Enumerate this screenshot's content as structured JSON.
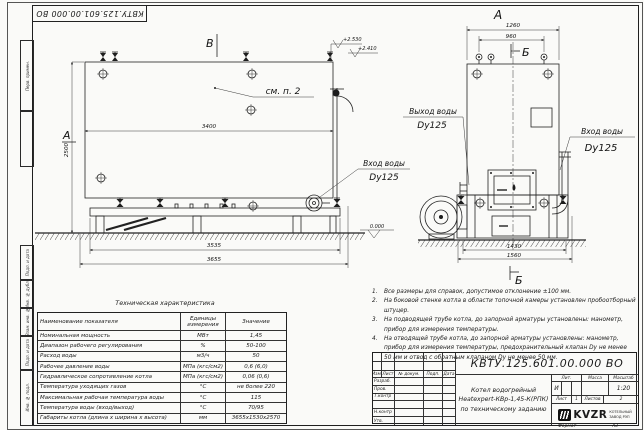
{
  "stamp": {
    "doc_number": "КВТУ.125.601.00.000  ВО"
  },
  "margin": {
    "labels": [
      "Перв. примен.",
      "Подп. и дата",
      "Инв. № дубл.",
      "Взам. инв. №",
      "Подп. и дата",
      "Инв. № подл."
    ]
  },
  "drawing": {
    "views": {
      "front_arrow": "В",
      "front_section": "А",
      "side_title": "А",
      "section_top": "Б",
      "section_bottom": "Б"
    },
    "dims": {
      "front_width": "3400",
      "front_height": "2500",
      "front_base": "3535",
      "front_overall": "3655",
      "side_top_outer": "1260",
      "side_top_inner": "960",
      "side_bottom_inner": "1430",
      "side_bottom_outer": "1560"
    },
    "elevations": {
      "e1": "+2.530",
      "e2": "+2.410",
      "ground": "0.000"
    },
    "callouts": {
      "see_note": "см. п. 2",
      "front_inlet": "Вход воды",
      "front_inlet_dn": "Dy125",
      "outlet": "Выход воды",
      "outlet_dn": "Dy125",
      "side_inlet": "Вход воды",
      "side_inlet_dn": "Dy125"
    }
  },
  "notes": {
    "items": [
      {
        "num": "1.",
        "text": "Все размеры для справок, допустимое отклонение ±100 мм."
      },
      {
        "num": "2.",
        "text": "На боковой стенке котла в области топочной камеры установлен пробоотборный штуцер."
      },
      {
        "num": "3.",
        "text": "На подводящей трубе котла, до запорной арматуры установлены: манометр, прибор для измерения температуры."
      },
      {
        "num": "4.",
        "text": "На отводящей трубе котла, до запорной арматуры установлены: манометр, прибор для измерения температуры, предохранительный клапан Dу не менее 50 мм и отвод с обратным клапаном Dу не менее 50 мм."
      }
    ]
  },
  "spec_table": {
    "title": "Техническая характеристика",
    "headers": [
      "Наименование показателя",
      "Единицы измерения",
      "Значение"
    ],
    "rows": [
      [
        "Номинальная мощность",
        "МВт",
        "1,45"
      ],
      [
        "Диапазон рабочего регулирования",
        "%",
        "50-100"
      ],
      [
        "Расход воды",
        "м3/ч",
        "50"
      ],
      [
        "Рабочее давление воды",
        "МПа (кгс/см2)",
        "0,6 (6,0)"
      ],
      [
        "Гидравлическое сопротивление котла",
        "МПа (кгс/см2)",
        "0,06 (0,6)"
      ],
      [
        "Температура уходящих газов",
        "°С",
        "не более 220"
      ],
      [
        "Максимальная рабочая температура воды",
        "°С",
        "115"
      ],
      [
        "Температура воды (вход/выход)",
        "°С",
        "70/95"
      ],
      [
        "Габариты котла (длина х ширина х высота)",
        "мм",
        "3655х1530х2570"
      ]
    ]
  },
  "title_block": {
    "doc_number": "КВТУ.125.601.00.000  ВО",
    "description_line1": "Котел водогрейный",
    "description_line2": "Heatexpert-КВр-1,45-К(РПК)",
    "description_line3": "по техническому заданию",
    "header_cols": [
      "Изм.",
      "Лист",
      "№ докум.",
      "Подп.",
      "Дата"
    ],
    "row_labels": [
      "Разраб.",
      "Пров.",
      "Т.контр",
      "",
      "Н.контр",
      "Утв."
    ],
    "lit_label": "Лит.",
    "lit_value": "И",
    "mass_label": "Масса",
    "scale_label": "Масштаб",
    "scale_value": "1:20",
    "sheet_label": "Лист",
    "sheet_value": "1",
    "sheets_label": "Листов",
    "sheets_value": "2",
    "logo_text": "KVZR",
    "logo_caption_line1": "КОТЕЛЬНЫЙ",
    "logo_caption_line2": "ЗАВОД РЭП"
  },
  "footer": {
    "format_label": "Формат",
    "format_value": "А3"
  }
}
